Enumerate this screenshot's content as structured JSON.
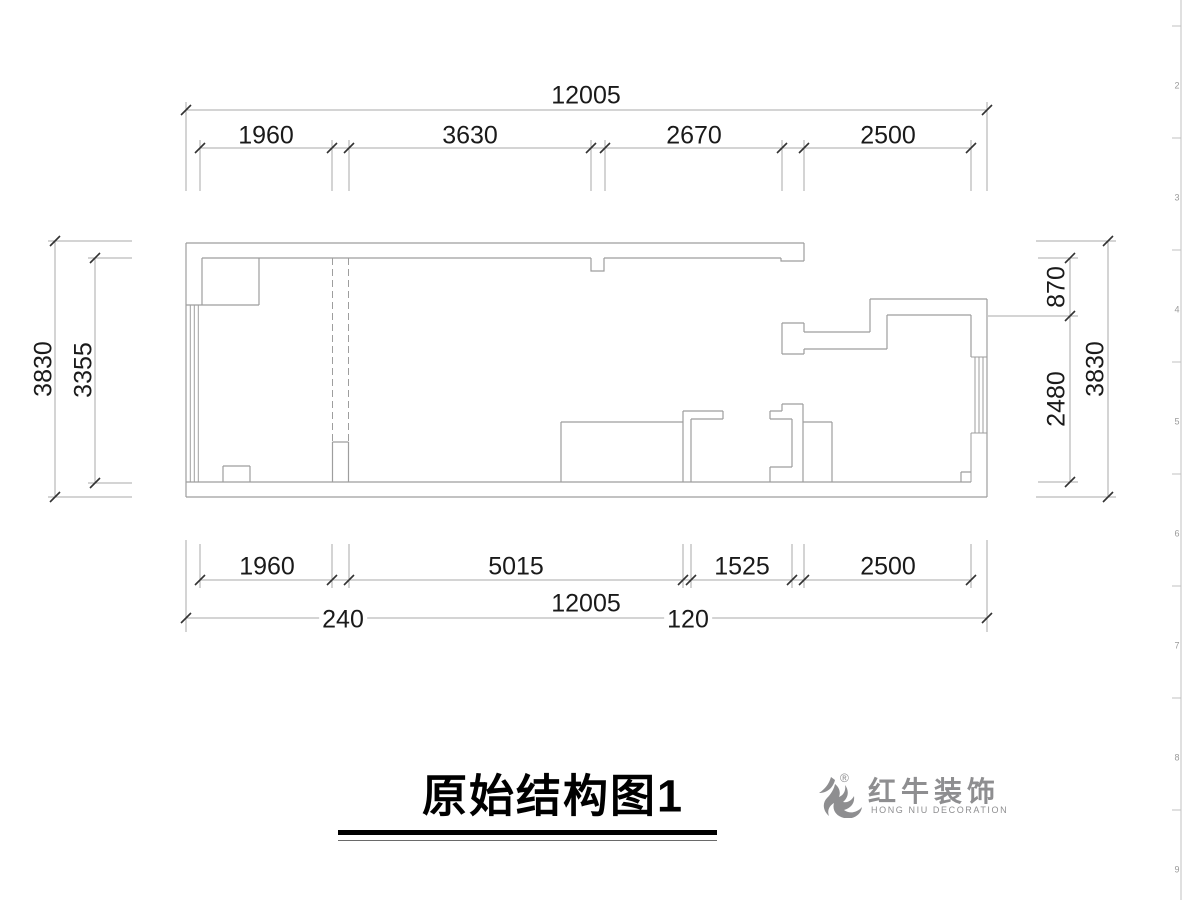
{
  "drawing": {
    "title": "原始结构图1",
    "dimensions": {
      "top_total": "12005",
      "top_segments": [
        "1960",
        "3630",
        "2670",
        "2500"
      ],
      "bottom_segments": [
        "1960",
        "5015",
        "1525",
        "2500"
      ],
      "bottom_total": "12005",
      "wall_thickness_labels": [
        "240",
        "120"
      ],
      "left": {
        "outer": "3830",
        "inner": "3355"
      },
      "right": {
        "outer": "3830",
        "upper": "870",
        "lower": "2480"
      }
    }
  },
  "logo": {
    "name_zh": "红牛装饰",
    "name_en": "HONG NIU DECORATION",
    "registered_mark": "®",
    "icon": "bull-icon"
  },
  "frame_ruler": {
    "numbers": [
      "2",
      "3",
      "4",
      "5",
      "6",
      "7",
      "8",
      "9"
    ]
  },
  "colors": {
    "wall_line": "#9e9e9e",
    "dimension_line": "#a8a8a8",
    "tick": "#333333",
    "dimension_text": "#1a1a1a",
    "title_text": "#000000",
    "logo_gray": "#8e8e90",
    "background": "#ffffff"
  }
}
